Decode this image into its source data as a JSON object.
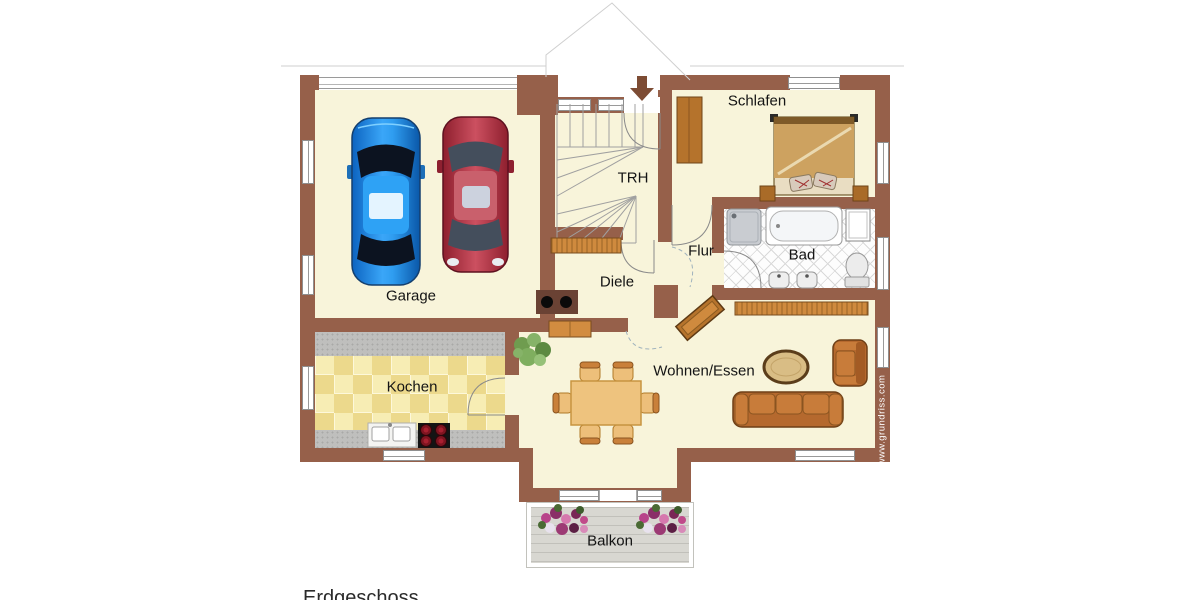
{
  "page": {
    "type": "floor-plan",
    "floor_caption": "Erdgeschoss"
  },
  "labels": {
    "garage": "Garage",
    "trh": "TRH",
    "schlafen": "Schlafen",
    "bad": "Bad",
    "flur": "Flur",
    "diele": "Diele",
    "kochen": "Kochen",
    "wohnen_essen": "Wohnen/Essen",
    "balkon": "Balkon"
  },
  "watermark": "www.grundriss.com",
  "colors": {
    "wall": "#96604a",
    "floor": "#f8f4da",
    "wood": "#b5732c",
    "kitchen_tile": "#ecd98c",
    "balcony": "#d8d7d1",
    "car_blue": "#1d8fe0",
    "car_red": "#b52d3c"
  },
  "icons": {
    "entrance_arrow": "down-arrow"
  }
}
